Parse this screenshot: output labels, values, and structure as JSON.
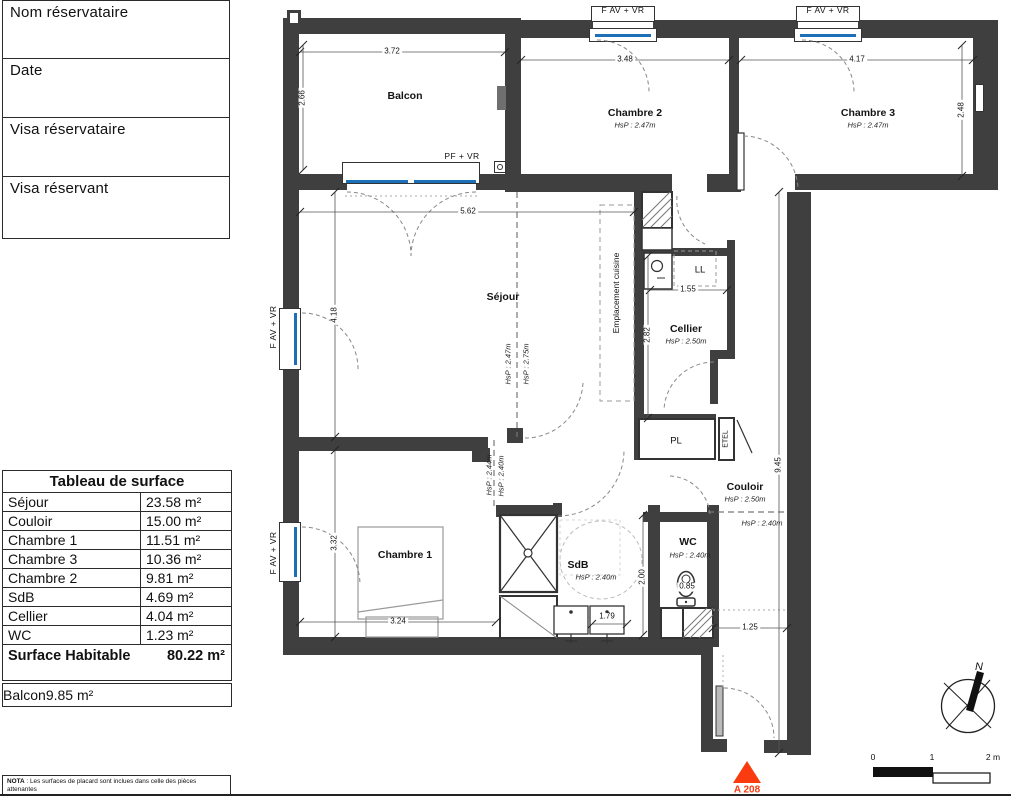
{
  "form": {
    "fields": [
      {
        "label": "Nom réservataire"
      },
      {
        "label": "Date"
      },
      {
        "label": "Visa réservataire"
      },
      {
        "label": "Visa réservant"
      }
    ]
  },
  "surface_table": {
    "title": "Tableau de surface",
    "rows": [
      {
        "label": "Séjour",
        "value": "23.58 m²"
      },
      {
        "label": "Couloir",
        "value": "15.00 m²"
      },
      {
        "label": "Chambre 1",
        "value": "11.51 m²"
      },
      {
        "label": "Chambre 3",
        "value": "10.36 m²"
      },
      {
        "label": "Chambre 2",
        "value": "9.81 m²"
      },
      {
        "label": "SdB",
        "value": "4.69 m²"
      },
      {
        "label": "Cellier",
        "value": "4.04 m²"
      },
      {
        "label": "WC",
        "value": "1.23 m²"
      }
    ],
    "total": {
      "label": "Surface Habitable",
      "value": "80.22 m²"
    },
    "balcony": {
      "label": "Balcon",
      "value": "9.85 m²"
    }
  },
  "nota": {
    "label": "NOTA",
    "text": " : Les surfaces de placard sont inclues dans celle des pièces attenantes"
  },
  "plan": {
    "rooms": {
      "balcon": {
        "name": "Balcon"
      },
      "chambre2": {
        "name": "Chambre 2",
        "hsp": "HsP : 2.47m"
      },
      "chambre3": {
        "name": "Chambre 3",
        "hsp": "HsP : 2.47m"
      },
      "sejour": {
        "name": "Séjour",
        "hsp1": "HsP : 2.47m",
        "hsp2": "HsP : 2.75m"
      },
      "cuisine": {
        "name": "Emplacement cuisine"
      },
      "cellier": {
        "name": "Cellier",
        "hsp": "HsP : 2.50m"
      },
      "chambre1": {
        "name": "Chambre 1"
      },
      "sdb": {
        "name": "SdB",
        "hsp": "HsP : 2.40m"
      },
      "wc": {
        "name": "WC",
        "hsp": "HsP : 2.40m"
      },
      "couloir": {
        "name": "Couloir",
        "hsp": "HsP : 2.50m",
        "hsp2": "HsP : 2.40m"
      },
      "pl": {
        "name": "PL"
      },
      "etel": {
        "name": "ETEL"
      },
      "ll": {
        "name": "LL"
      }
    },
    "door_hsp": {
      "left": "HsP : 2.44m",
      "right": "HsP : 2.40m"
    },
    "window_labels": {
      "fav_vr": "F AV + VR",
      "pf_vr": "PF + VR"
    },
    "dims": {
      "d372": "3.72",
      "d266": "2.66",
      "d348": "3.48",
      "d417": "4.17",
      "d248": "2.48",
      "d562": "5.62",
      "d418": "4.18",
      "d155": "1.55",
      "d282": "2.82",
      "d945": "9.45",
      "d332": "3.32",
      "d324": "3.24",
      "d179": "1.79",
      "d200": "2.00",
      "d085": "0.85",
      "d125": "1.25"
    },
    "annotations": {
      "unit": "A 208",
      "north": "N",
      "scale0": "0",
      "scale1": "1",
      "scale2": "2 m"
    },
    "colors": {
      "wall": "#3f3f3f",
      "glazing": "#1d6fb8",
      "accent": "#f93b0f"
    }
  }
}
